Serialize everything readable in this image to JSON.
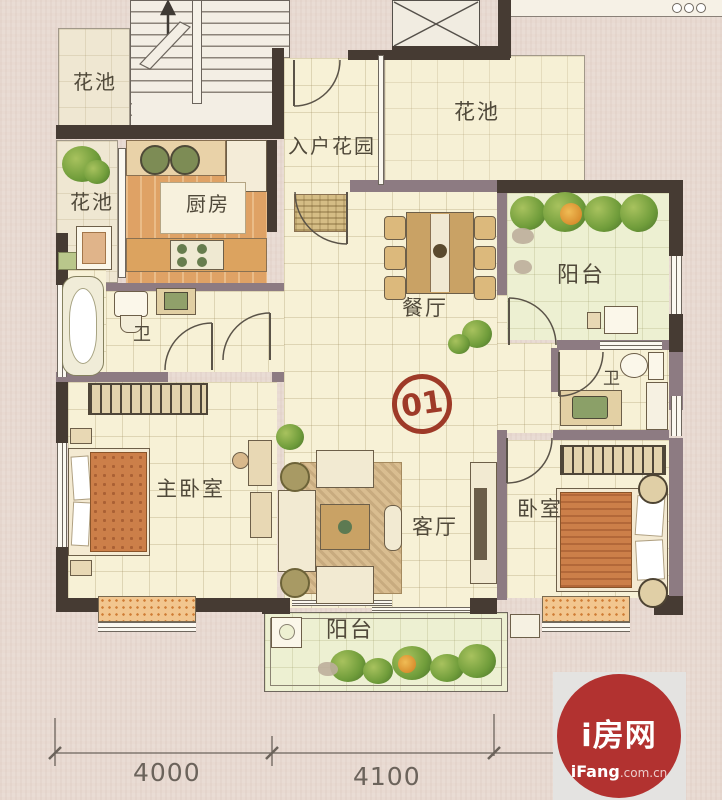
{
  "labels": {
    "flower_top_left": "花池",
    "flower_left": "花池",
    "flower_top_right": "花池",
    "entry_garden": "入户花园",
    "kitchen": "厨房",
    "dining": "餐厅",
    "balcony_right": "阳台",
    "bath1": "卫",
    "bath2": "卫",
    "master_bedroom": "主卧室",
    "living": "客厅",
    "bedroom": "卧室",
    "balcony_bottom": "阳台"
  },
  "unit": {
    "number": "01"
  },
  "dimensions": {
    "left": "4000",
    "right": "4100"
  },
  "watermark": {
    "title": "i房网",
    "brand": "iFang",
    "domain": ".com.cn"
  },
  "colors": {
    "wall_dark": "#463b33",
    "wall_light": "#8d7b82",
    "floor_cream": "#f7f1d6",
    "floor_green": "#edf0d2",
    "kitchen_orange": "#dfa265",
    "accent_red": "#9e3a28",
    "logo_red": "#b23230"
  }
}
